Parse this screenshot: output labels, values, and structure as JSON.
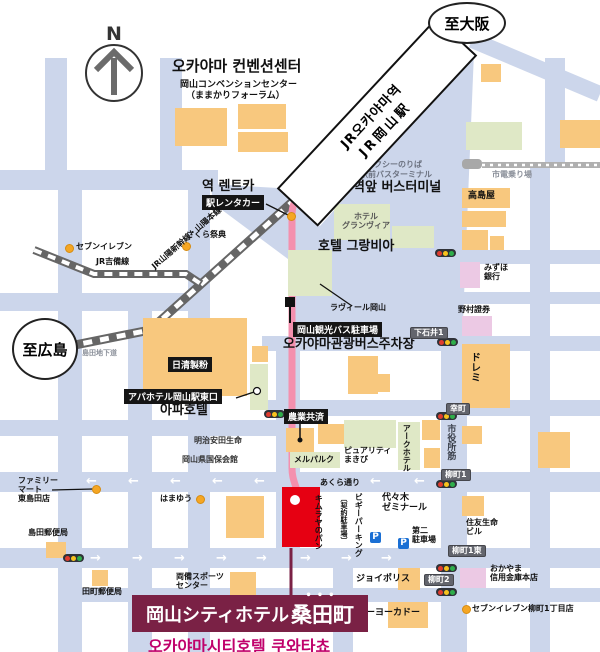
{
  "compass": {
    "n": "N"
  },
  "bubbles": {
    "to_osaka": "至大阪",
    "to_hiroshima": "至広島"
  },
  "station": {
    "name_kr": "JR오카야마역",
    "name_jp": "JR岡山駅",
    "east_exit_jp": "東口",
    "east_exit_kr": "동쪽출구",
    "taxi_stand": "タクシーのりば",
    "bus_terminal_jp": "駅前バスターミナル",
    "bus_terminal_kr": "역앞 버스터미널",
    "tram_stop": "市電乗り場"
  },
  "railways": {
    "sanyo": "JR山陽新幹線・山陽本線",
    "kibi": "JR吉備線"
  },
  "convention_center": {
    "kr": "오카야마 컨벤션센터",
    "jp": "岡山コンベンションセンター",
    "jp2": "（ままかりフォーラム）"
  },
  "rentacar": {
    "kr": "역 렌트카",
    "jp": "駅レンタカー"
  },
  "granvia": {
    "jp1": "ホテル",
    "jp2": "グランヴィア",
    "kr": "호텔 그랑비아"
  },
  "bus_parking": {
    "jp": "岡山観光バス駐車場",
    "kr": "오카야마관광버스주차장"
  },
  "apa": {
    "jp": "アパホテル岡山駅東口",
    "kr": "아파호텔"
  },
  "hotel": {
    "jp": "岡山シティホテル",
    "jp_stylized": "桑田町",
    "dots": "•••",
    "kr": "오카야마시티호텔 쿠와타쵸"
  },
  "pois": {
    "sakura": "さくら祭典",
    "seven_eleven": "セブンイレブン",
    "takashimaya": "高島屋",
    "mizuho1": "みずほ",
    "mizuho2": "銀行",
    "nomura": "野村證券",
    "doremi": "ドレミ",
    "ravir": "ラヴィール岡山",
    "shimada_underpass": "島田地下道",
    "nisshin": "日清製粉",
    "meiji": "明治安田生命",
    "kokuho": "岡山県国保会館",
    "nogyo": "農業共済",
    "melparque": "メルパルク",
    "purity1": "ピュアリティ",
    "purity2": "まきび",
    "ark": "アークホテル",
    "family1": "ファミリー",
    "family2": "マート",
    "family3": "東島田店",
    "shimada_po": "島田郵便局",
    "tamachi_po": "田町郵便局",
    "hamayu": "はまゆう",
    "ryobi1": "両備スポーツ",
    "ryobi2": "センター",
    "kimuraya": "キムラヤのパン",
    "biggy": "ビギーパーキング",
    "biggy2": "〔契約駐車場〕",
    "yoyogi1": "代々木",
    "yoyogi2": "ゼミナール",
    "daini1": "第二",
    "daini2": "駐車場",
    "sumitomo1": "住友生命",
    "sumitomo2": "ビル",
    "joypolis": "ジョイポリス",
    "shinkin1": "おかやま",
    "shinkin2": "信用金庫本店",
    "itoyokado": "イトーヨーカドー",
    "seven_eleven2": "セブンイレブン柳町1丁目店"
  },
  "streets": {
    "shiyakusho": "市役所筋",
    "akura": "あくら通り"
  },
  "road_signs": {
    "shimoishii1": "下石井1",
    "saiwaicho": "幸町",
    "yanagimachi1": "柳町1",
    "yanagimachi1e": "柳町1東",
    "yanagimachi2": "柳町2"
  },
  "icons": {
    "parking": "P",
    "arrow_left": "←",
    "arrow_right": "→"
  },
  "colors": {
    "road": "#ccd6eb",
    "building_orange": "#f8c87e",
    "building_green": "#dfe8c6",
    "building_pink": "#ecc9e4",
    "hotel_red": "#e60012",
    "banner_maroon": "#7a2145",
    "korean_pink": "#c0006b",
    "route_pink": "#f490ae"
  }
}
